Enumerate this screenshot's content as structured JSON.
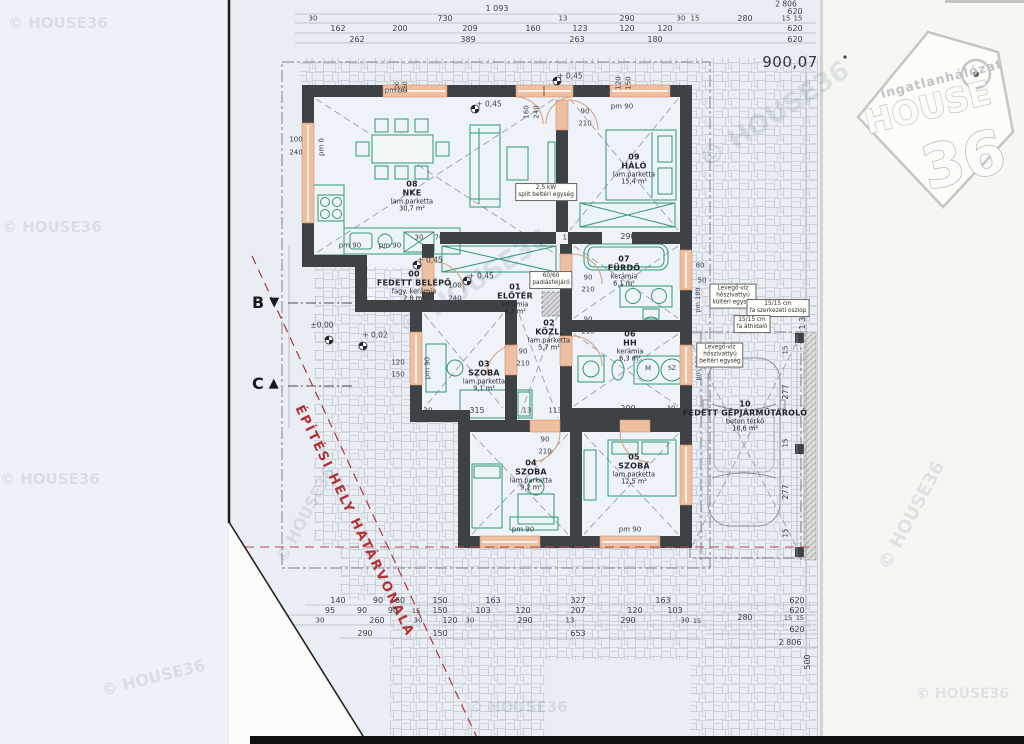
{
  "meta": {
    "plot_number": "900,07"
  },
  "logo": {
    "line1": "ingatlanhálózat",
    "line2": "HOUSE",
    "line3": "36"
  },
  "boundary": {
    "label": "ÉPÍTÉSI HELY HATÁRVONALA"
  },
  "markers": [
    {
      "x": 252,
      "y": 293,
      "t": "B",
      "dir": "down"
    },
    {
      "x": 252,
      "y": 374,
      "t": "C",
      "dir": "up"
    }
  ],
  "rooms": [
    {
      "num": "08",
      "name": "NKE",
      "mat": "lam.parketta",
      "area": "30,7 m²",
      "x": 412,
      "y": 197
    },
    {
      "num": "09",
      "name": "HÁLÓ",
      "mat": "lam.parketta",
      "area": "15,4 m²",
      "x": 634,
      "y": 170
    },
    {
      "num": "00",
      "name": "FEDETT BELÉPŐ",
      "mat": "fagy. kerámia",
      "area": "2,8 m²",
      "x": 414,
      "y": 287
    },
    {
      "num": "01",
      "name": "ELŐTÉR",
      "mat": "kerámia",
      "area": "4,3 m²",
      "x": 515,
      "y": 300
    },
    {
      "num": "02",
      "name": "KÖZL.",
      "mat": "lam.parketta",
      "area": "5,7 m²",
      "x": 549,
      "y": 336
    },
    {
      "num": "07",
      "name": "FÜRDŐ",
      "mat": "kerámia",
      "area": "6,1 m²",
      "x": 624,
      "y": 272
    },
    {
      "num": "06",
      "name": "HH",
      "mat": "kerámia",
      "area": "6,3 m²",
      "x": 630,
      "y": 347
    },
    {
      "num": "03",
      "name": "SZOBA",
      "mat": "lam.parketta",
      "area": "9,1 m²",
      "x": 484,
      "y": 377
    },
    {
      "num": "04",
      "name": "SZOBA",
      "mat": "lam.parketta",
      "area": "9,2 m²",
      "x": 531,
      "y": 476
    },
    {
      "num": "05",
      "name": "SZOBA",
      "mat": "lam.parketta",
      "area": "12,5 m²",
      "x": 634,
      "y": 470
    },
    {
      "num": "10",
      "name": "FEDETT GÉPJÁRMŰTÁROLÓ",
      "mat": "beton térkő",
      "area": "18,6 m²",
      "x": 745,
      "y": 417
    }
  ],
  "annotations": [
    {
      "x": 546,
      "y": 192,
      "lines": [
        "2,5 kW",
        "split beltéri egység"
      ]
    },
    {
      "x": 733,
      "y": 296,
      "lines": [
        "Levegő-víz",
        "hőszivattyú",
        "kültéri egység"
      ]
    },
    {
      "x": 778,
      "y": 308,
      "lines": [
        "15/15 cm",
        "fa szerkezeti oszlop"
      ]
    },
    {
      "x": 752,
      "y": 324,
      "lines": [
        "15/15 cm",
        "fa áthidaló"
      ]
    },
    {
      "x": 720,
      "y": 355,
      "lines": [
        "Levegő-víz",
        "hőszivattyú",
        "beltéri egység"
      ]
    },
    {
      "x": 551,
      "y": 280,
      "lines": [
        "60/60",
        "padlásfeljáró"
      ]
    }
  ],
  "dims": [
    {
      "t": "1 093",
      "x": 497,
      "y": 9
    },
    {
      "t": "2 806",
      "x": 786,
      "y": 4,
      "fs": 7.5
    },
    {
      "t": "620",
      "x": 795,
      "y": 12
    },
    {
      "t": "30",
      "x": 313,
      "y": 19,
      "fs": 7
    },
    {
      "t": "730",
      "x": 445,
      "y": 19
    },
    {
      "t": "13",
      "x": 563,
      "y": 19,
      "fs": 7
    },
    {
      "t": "290",
      "x": 627,
      "y": 19
    },
    {
      "t": "30",
      "x": 681,
      "y": 19,
      "fs": 7
    },
    {
      "t": "15",
      "x": 695,
      "y": 19,
      "fs": 7
    },
    {
      "t": "280",
      "x": 745,
      "y": 19
    },
    {
      "t": "15",
      "x": 786,
      "y": 19,
      "fs": 7
    },
    {
      "t": "15",
      "x": 798,
      "y": 19,
      "fs": 7
    },
    {
      "t": "162",
      "x": 338,
      "y": 29
    },
    {
      "t": "200",
      "x": 400,
      "y": 29
    },
    {
      "t": "209",
      "x": 470,
      "y": 29
    },
    {
      "t": "160",
      "x": 533,
      "y": 29
    },
    {
      "t": "123",
      "x": 580,
      "y": 29
    },
    {
      "t": "120",
      "x": 627,
      "y": 29
    },
    {
      "t": "120",
      "x": 665,
      "y": 29
    },
    {
      "t": "620",
      "x": 795,
      "y": 29
    },
    {
      "t": "262",
      "x": 357,
      "y": 40
    },
    {
      "t": "389",
      "x": 468,
      "y": 40
    },
    {
      "t": "263",
      "x": 577,
      "y": 40
    },
    {
      "t": "180",
      "x": 655,
      "y": 40
    },
    {
      "t": "620",
      "x": 795,
      "y": 40
    },
    {
      "t": "pm 90",
      "x": 396,
      "y": 91,
      "fs": 7
    },
    {
      "t": "200",
      "x": 398,
      "y": 87,
      "r": -90,
      "fs": 6
    },
    {
      "t": "150",
      "x": 406,
      "y": 87,
      "r": -90,
      "fs": 6
    },
    {
      "t": "160",
      "x": 527,
      "y": 112,
      "r": -90,
      "fs": 7
    },
    {
      "t": "240",
      "x": 537,
      "y": 112,
      "r": -90,
      "fs": 7
    },
    {
      "t": "120",
      "x": 619,
      "y": 83,
      "r": -90,
      "fs": 7
    },
    {
      "t": "150",
      "x": 629,
      "y": 83,
      "r": -90,
      "fs": 7
    },
    {
      "t": "pm 90",
      "x": 622,
      "y": 107,
      "fs": 7
    },
    {
      "t": "90",
      "x": 585,
      "y": 112,
      "fs": 7
    },
    {
      "t": "210",
      "x": 585,
      "y": 124,
      "fs": 7
    },
    {
      "t": "100",
      "x": 296,
      "y": 140,
      "fs": 7
    },
    {
      "t": "240",
      "x": 296,
      "y": 153,
      "fs": 7
    },
    {
      "t": "pm 0",
      "x": 322,
      "y": 147,
      "r": -90,
      "fs": 7
    },
    {
      "t": "+ 0,45",
      "x": 489,
      "y": 104,
      "fs": 7.5
    },
    {
      "t": "+ 0,45",
      "x": 570,
      "y": 76,
      "fs": 7.5
    },
    {
      "t": "+ 0,45",
      "x": 430,
      "y": 260,
      "fs": 7.5
    },
    {
      "t": "+ 0,45",
      "x": 481,
      "y": 276,
      "fs": 7.5
    },
    {
      "t": "±0,00",
      "x": 322,
      "y": 325,
      "fs": 7.5
    },
    {
      "t": "+ 0,02",
      "x": 375,
      "y": 335,
      "fs": 7.5
    },
    {
      "t": "pm 90",
      "x": 350,
      "y": 246,
      "fs": 7
    },
    {
      "t": "pm 90",
      "x": 390,
      "y": 246,
      "fs": 7
    },
    {
      "t": "30",
      "x": 419,
      "y": 238,
      "fs": 7
    },
    {
      "t": "70",
      "x": 439,
      "y": 238,
      "fs": 7
    },
    {
      "t": "30",
      "x": 458,
      "y": 238,
      "fs": 7
    },
    {
      "t": "340",
      "x": 513,
      "y": 238
    },
    {
      "t": "13",
      "x": 567,
      "y": 238,
      "fs": 7
    },
    {
      "t": "290",
      "x": 628,
      "y": 237
    },
    {
      "t": "30",
      "x": 671,
      "y": 237,
      "fs": 7
    },
    {
      "t": "100",
      "x": 455,
      "y": 286,
      "fs": 7
    },
    {
      "t": "240",
      "x": 455,
      "y": 299,
      "fs": 7
    },
    {
      "t": "90",
      "x": 588,
      "y": 278,
      "fs": 7
    },
    {
      "t": "210",
      "x": 588,
      "y": 290,
      "fs": 7
    },
    {
      "t": "90",
      "x": 588,
      "y": 320,
      "fs": 7
    },
    {
      "t": "210",
      "x": 588,
      "y": 332,
      "fs": 7
    },
    {
      "t": "90",
      "x": 523,
      "y": 352,
      "fs": 7
    },
    {
      "t": "210",
      "x": 523,
      "y": 364,
      "fs": 7
    },
    {
      "t": "120",
      "x": 398,
      "y": 363,
      "fs": 7
    },
    {
      "t": "150",
      "x": 398,
      "y": 375,
      "fs": 7
    },
    {
      "t": "pm 90",
      "x": 428,
      "y": 368,
      "r": -90,
      "fs": 7
    },
    {
      "t": "290",
      "x": 628,
      "y": 409
    },
    {
      "t": "30",
      "x": 671,
      "y": 409,
      "fs": 7
    },
    {
      "t": "30",
      "x": 428,
      "y": 411,
      "fs": 7
    },
    {
      "t": "315",
      "x": 477,
      "y": 411
    },
    {
      "t": "13",
      "x": 527,
      "y": 411,
      "fs": 7
    },
    {
      "t": "113",
      "x": 555,
      "y": 411,
      "fs": 7
    },
    {
      "t": "90",
      "x": 545,
      "y": 440,
      "fs": 7
    },
    {
      "t": "210",
      "x": 545,
      "y": 452,
      "fs": 7
    },
    {
      "t": "pm 90",
      "x": 523,
      "y": 530,
      "fs": 7
    },
    {
      "t": "pm 90",
      "x": 630,
      "y": 530,
      "fs": 7
    },
    {
      "t": "80",
      "x": 700,
      "y": 266,
      "fs": 7
    },
    {
      "t": "50",
      "x": 702,
      "y": 281,
      "fs": 7
    },
    {
      "t": "pm 180",
      "x": 698,
      "y": 300,
      "r": -90,
      "fs": 6.5
    },
    {
      "t": "60",
      "x": 688,
      "y": 315,
      "fs": 7
    },
    {
      "t": "60",
      "x": 688,
      "y": 329,
      "fs": 7
    },
    {
      "t": "pm 180",
      "x": 698,
      "y": 368,
      "r": -90,
      "fs": 6.5
    },
    {
      "t": "M",
      "x": 648,
      "y": 369,
      "fs": 7
    },
    {
      "t": "SZ",
      "x": 672,
      "y": 369,
      "fs": 6
    },
    {
      "t": "15",
      "x": 786,
      "y": 350,
      "r": -90,
      "fs": 7
    },
    {
      "t": "277",
      "x": 786,
      "y": 392,
      "r": -90
    },
    {
      "t": "15",
      "x": 786,
      "y": 443,
      "r": -90,
      "fs": 7
    },
    {
      "t": "277",
      "x": 786,
      "y": 492,
      "r": -90
    },
    {
      "t": "15",
      "x": 786,
      "y": 533,
      "r": -90,
      "fs": 7
    },
    {
      "t": "1 318",
      "x": 803,
      "y": 318,
      "r": -90
    },
    {
      "t": "500",
      "x": 808,
      "y": 662,
      "r": -90
    },
    {
      "t": "140",
      "x": 338,
      "y": 601
    },
    {
      "t": "90",
      "x": 378,
      "y": 601
    },
    {
      "t": "60",
      "x": 400,
      "y": 601
    },
    {
      "t": "150",
      "x": 440,
      "y": 601
    },
    {
      "t": "163",
      "x": 493,
      "y": 601
    },
    {
      "t": "327",
      "x": 578,
      "y": 601
    },
    {
      "t": "163",
      "x": 663,
      "y": 601
    },
    {
      "t": "620",
      "x": 797,
      "y": 601
    },
    {
      "t": "95",
      "x": 330,
      "y": 611
    },
    {
      "t": "90",
      "x": 362,
      "y": 611
    },
    {
      "t": "90",
      "x": 393,
      "y": 611
    },
    {
      "t": "15",
      "x": 416,
      "y": 611,
      "fs": 6.5
    },
    {
      "t": "150",
      "x": 440,
      "y": 611
    },
    {
      "t": "103",
      "x": 483,
      "y": 611
    },
    {
      "t": "120",
      "x": 523,
      "y": 611
    },
    {
      "t": "207",
      "x": 578,
      "y": 611
    },
    {
      "t": "120",
      "x": 635,
      "y": 611
    },
    {
      "t": "103",
      "x": 675,
      "y": 611
    },
    {
      "t": "620",
      "x": 797,
      "y": 611
    },
    {
      "t": "30",
      "x": 320,
      "y": 621,
      "fs": 7
    },
    {
      "t": "260",
      "x": 377,
      "y": 621
    },
    {
      "t": "30",
      "x": 418,
      "y": 621,
      "fs": 7
    },
    {
      "t": "120",
      "x": 450,
      "y": 621
    },
    {
      "t": "30",
      "x": 470,
      "y": 621,
      "fs": 7
    },
    {
      "t": "290",
      "x": 525,
      "y": 621
    },
    {
      "t": "13",
      "x": 570,
      "y": 621,
      "fs": 7
    },
    {
      "t": "290",
      "x": 628,
      "y": 621
    },
    {
      "t": "30",
      "x": 685,
      "y": 621,
      "fs": 7
    },
    {
      "t": "15",
      "x": 697,
      "y": 621,
      "fs": 6.5
    },
    {
      "t": "280",
      "x": 745,
      "y": 618
    },
    {
      "t": "15",
      "x": 788,
      "y": 618,
      "fs": 6.5
    },
    {
      "t": "15",
      "x": 800,
      "y": 618,
      "fs": 6.5
    },
    {
      "t": "290",
      "x": 365,
      "y": 634
    },
    {
      "t": "150",
      "x": 440,
      "y": 634
    },
    {
      "t": "653",
      "x": 578,
      "y": 634
    },
    {
      "t": "620",
      "x": 797,
      "y": 630
    },
    {
      "t": "2 806",
      "x": 790,
      "y": 643
    }
  ],
  "watermarks": [
    {
      "t": "© HOUSE36",
      "x": 8,
      "y": 14,
      "fs": 15,
      "r": 0
    },
    {
      "t": "© HOUSE36",
      "x": 2,
      "y": 218,
      "fs": 15,
      "r": 0
    },
    {
      "t": "© HOUSE36",
      "x": 0,
      "y": 470,
      "fs": 15,
      "r": 0
    },
    {
      "t": "© HOUSE36",
      "x": 100,
      "y": 668,
      "fs": 16,
      "r": -14
    },
    {
      "t": "© HOUSE36",
      "x": 252,
      "y": 505,
      "fs": 16,
      "r": -62
    },
    {
      "t": "© HOUSE36",
      "x": 388,
      "y": 268,
      "fs": 26,
      "r": -33
    },
    {
      "t": "© HOUSE36",
      "x": 688,
      "y": 100,
      "fs": 26,
      "r": -33
    },
    {
      "t": "© HOUSE36",
      "x": 468,
      "y": 698,
      "fs": 15,
      "r": 0
    },
    {
      "t": "© HOUSE36",
      "x": 852,
      "y": 505,
      "fs": 18,
      "r": -62
    },
    {
      "t": "© HOUSE36",
      "x": 916,
      "y": 686,
      "fs": 14,
      "r": 0
    }
  ]
}
